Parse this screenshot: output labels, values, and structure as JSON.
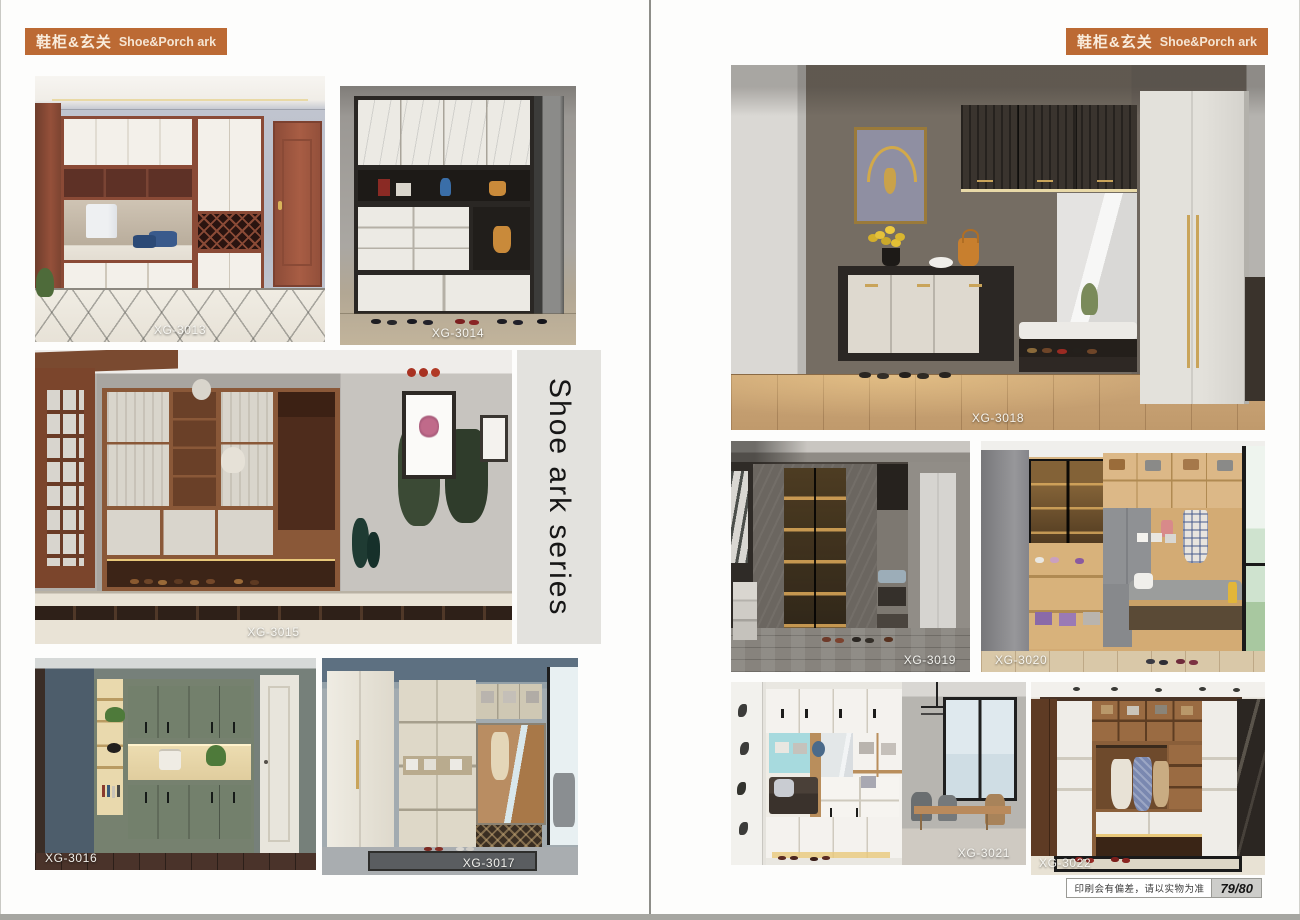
{
  "header": {
    "title_zh": "鞋柜&玄关",
    "title_en": "Shoe&Porch ark"
  },
  "series_title": "Shoe ark series",
  "photos": {
    "xg3013": {
      "label": "XG-3013"
    },
    "xg3014": {
      "label": "XG-3014"
    },
    "xg3015": {
      "label": "XG-3015"
    },
    "xg3016": {
      "label": "XG-3016"
    },
    "xg3017": {
      "label": "XG-3017"
    },
    "xg3018": {
      "label": "XG-3018"
    },
    "xg3019": {
      "label": "XG-3019"
    },
    "xg3020": {
      "label": "XG-3020"
    },
    "xg3021": {
      "label": "XG-3021"
    },
    "xg3022": {
      "label": "XG-3022"
    }
  },
  "footer": {
    "disclaimer": "印刷会有偏差，请以实物为准",
    "page_number": "79/80"
  },
  "colors": {
    "accent": "#bc6a34",
    "series_bg": "#e3e2de",
    "divider": "#8e8e89"
  }
}
